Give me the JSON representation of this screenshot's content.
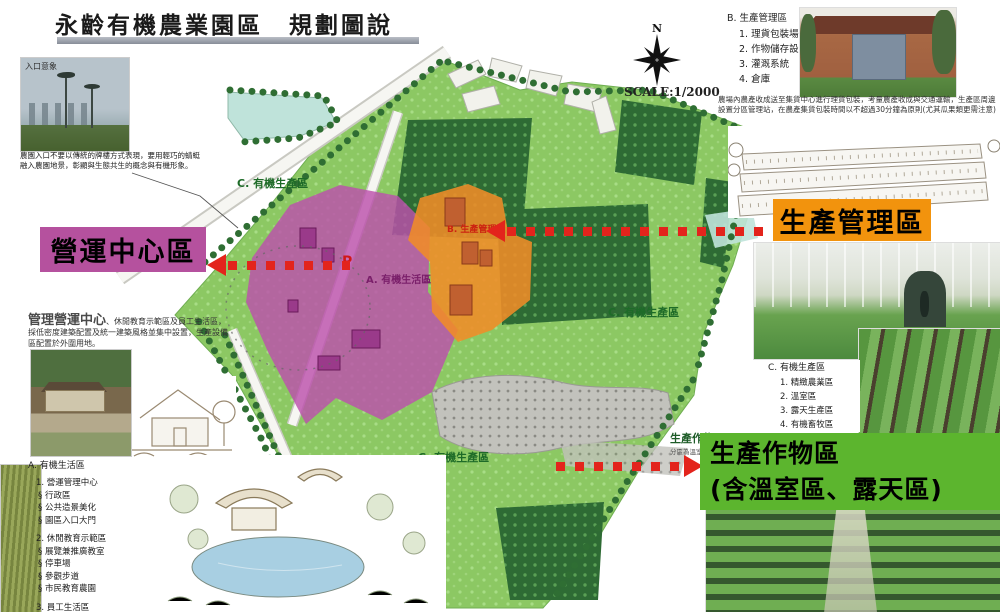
{
  "title": "永齡有機農業園區　規劃圖說",
  "entrance": {
    "caption": "入口意象",
    "description": "農園入口不要以傳統的牌樓方式表現，要用輕巧的蜻蜓融入農園地景，彰顯與生態共生的概念與有機形象。"
  },
  "compass": {
    "north": "N",
    "scale": "SCALE:1/2000"
  },
  "section_b": {
    "heading": "B. 生產管理區",
    "items": [
      "1. 理貨包裝場",
      "2. 作物儲存設施",
      "3. 灌溉系統",
      "4. 倉庫"
    ],
    "note": "農場內農產收成送至集貨中心進行理貨包裝，考量農產收成與交通運輸，生產區周邊設置分區管理站，在農產集貨包裝時間以不超過30分鐘為原則(尤其瓜果類更需注意)"
  },
  "labels": {
    "production_mgmt": "生產管理區",
    "operation_center": "營運中心區",
    "production_crops_line1": "生產作物區",
    "production_crops_line2": "(含溫室區、露天區)"
  },
  "crops_note": {
    "title": "生產作物區",
    "sub": "分區為溫室區、精"
  },
  "mgmt_note": {
    "lead": "管理營運中心",
    "rest": "、休閒教育示範區及員工生活區，採低密度建築配置及統一建築風格並集中設置，生產設備區配置於外圍用地。"
  },
  "section_a": {
    "heading": "A. 有機生活區",
    "group1_title": "1. 營運管理中心",
    "group1_items": [
      "§ 行政區",
      "§ 公共造景美化",
      "§ 園區入口大門"
    ],
    "group2_title": "2. 休閒教育示範區",
    "group2_items": [
      "§ 展覽兼推廣教室",
      "§ 停車場",
      "§ 參觀步道",
      "§ 市民教育農園"
    ],
    "group3_title": "3. 員工生活區",
    "group3_items": [
      "§ 員工餐廳",
      "§ 宿舍區"
    ]
  },
  "section_c": {
    "heading": "C. 有機生產區",
    "items": [
      "1. 精緻農業區",
      "2. 溫室區",
      "3. 露天生產區",
      "4. 有機畜牧區"
    ]
  },
  "map": {
    "zone_c_label": "C. 有機生產區",
    "zone_a_label": "A. 有機生活區",
    "zone_b_label": "B. 生產管理區",
    "parking": "P"
  },
  "colors": {
    "accent_orange": "#F2930D",
    "accent_purple": "#B5519E",
    "accent_green": "#5CB52E",
    "arrow_red": "#E3241C",
    "park_green": "#8CC863",
    "orchard_green": "#2E6B34"
  }
}
